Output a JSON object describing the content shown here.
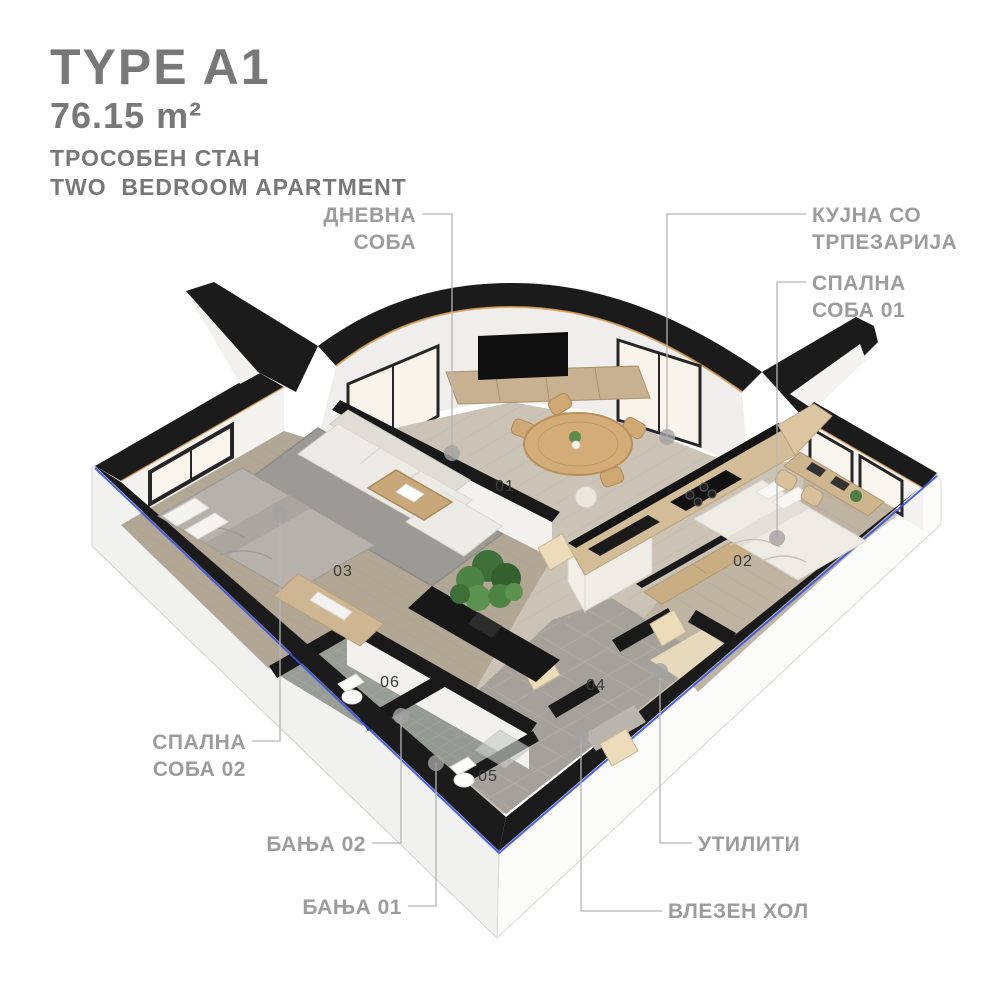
{
  "header": {
    "type_label": "TYPE A1",
    "area": "76.15 m²",
    "subtitle_mk": "ТРОСОБЕН СТАН",
    "subtitle_en": "TWO  BEDROOM APARTMENT"
  },
  "colors": {
    "title_gray": "#78787a",
    "label_gray": "#9c9c9c",
    "leader_gray": "#b5b5b5",
    "dot_gray": "#a3a3a3",
    "wall_black": "#1b1b1b",
    "accent_blue": "#3752e2",
    "wood_trim_tan": "#d79e55"
  },
  "room_labels": [
    {
      "id": "living-room",
      "lines": [
        "ДНЕВНА",
        "СОБА"
      ],
      "align": "right",
      "x": 416,
      "y": 202,
      "leader": [
        [
          422,
          214
        ],
        [
          452,
          214
        ],
        [
          452,
          453
        ]
      ],
      "dot": [
        452,
        453
      ]
    },
    {
      "id": "kitchen-dining",
      "lines": [
        "КУЈНА СО",
        "ТРПЕЗАРИЈА"
      ],
      "align": "left",
      "x": 812,
      "y": 202,
      "leader": [
        [
          806,
          214
        ],
        [
          667,
          214
        ],
        [
          667,
          437
        ]
      ],
      "dot": [
        667,
        437
      ]
    },
    {
      "id": "bedroom-01",
      "lines": [
        "СПАЛНА",
        "СОБА 01"
      ],
      "align": "left",
      "x": 812,
      "y": 270,
      "leader": [
        [
          806,
          282
        ],
        [
          777,
          282
        ],
        [
          777,
          538
        ]
      ],
      "dot": [
        777,
        538
      ]
    },
    {
      "id": "bedroom-02",
      "lines": [
        "СПАЛНА",
        "СОБА 02"
      ],
      "align": "right",
      "x": 246,
      "y": 729,
      "leader": [
        [
          252,
          741
        ],
        [
          280,
          741
        ],
        [
          280,
          515
        ]
      ],
      "dot": [
        280,
        515
      ]
    },
    {
      "id": "bathroom-02",
      "lines": [
        "БАЊА 02"
      ],
      "align": "right",
      "x": 366,
      "y": 831,
      "leader": [
        [
          372,
          843
        ],
        [
          401,
          843
        ],
        [
          401,
          716
        ]
      ],
      "dot": [
        401,
        716
      ]
    },
    {
      "id": "bathroom-01",
      "lines": [
        "БАЊА 01"
      ],
      "align": "right",
      "x": 402,
      "y": 894,
      "leader": [
        [
          408,
          906
        ],
        [
          436,
          906
        ],
        [
          436,
          763
        ]
      ],
      "dot": [
        436,
        763
      ]
    },
    {
      "id": "utility",
      "lines": [
        "УТИЛИТИ"
      ],
      "align": "left",
      "x": 698,
      "y": 831,
      "leader": [
        [
          692,
          843
        ],
        [
          660,
          843
        ],
        [
          660,
          671
        ]
      ],
      "dot": [
        660,
        671
      ]
    },
    {
      "id": "entry-hall",
      "lines": [
        "ВЛЕЗЕН ХОЛ"
      ],
      "align": "left",
      "x": 668,
      "y": 898,
      "leader": [
        [
          662,
          911
        ],
        [
          581,
          911
        ],
        [
          581,
          736
        ]
      ],
      "dot": [
        581,
        736
      ]
    }
  ],
  "room_numbers": [
    {
      "n": "01",
      "x": 505,
      "y": 487
    },
    {
      "n": "02",
      "x": 743,
      "y": 562
    },
    {
      "n": "03",
      "x": 343,
      "y": 572
    },
    {
      "n": "04",
      "x": 596,
      "y": 686
    },
    {
      "n": "05",
      "x": 488,
      "y": 777
    },
    {
      "n": "06",
      "x": 390,
      "y": 683
    }
  ]
}
